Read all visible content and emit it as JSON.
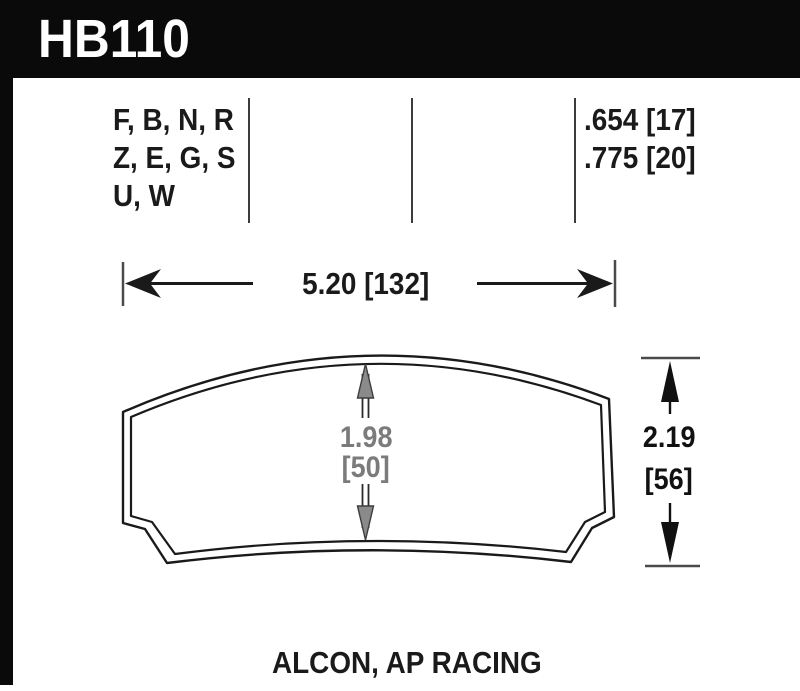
{
  "part": {
    "number": "HB110"
  },
  "spec_columns": {
    "compounds": {
      "line1": "F, B, N, R",
      "line2": "Z, E, G, S",
      "line3": "U, W"
    },
    "thickness": {
      "line1": ".654 [17]",
      "line2": ".775 [20]"
    }
  },
  "dimensions": {
    "width": {
      "label": "5.20 [132]"
    },
    "height": {
      "inches": "2.19",
      "mm": "[56]"
    },
    "center": {
      "inches": "1.98",
      "mm": "[50]"
    }
  },
  "footer": {
    "applications": "ALCON, AP RACING"
  },
  "colors": {
    "banner": "#0a0a0a",
    "ink": "#1a1a1a",
    "dim_gray": "#7b7b7b",
    "paper": "#ffffff"
  }
}
